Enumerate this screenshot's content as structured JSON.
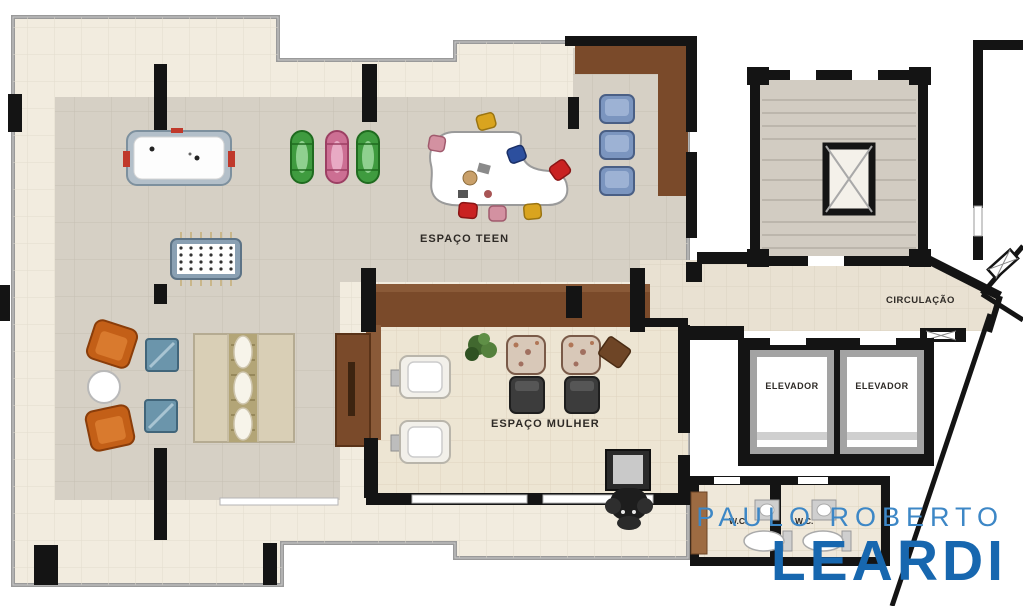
{
  "document": {
    "type": "residential floor plan (leisure floor)"
  },
  "rooms": {
    "teen": {
      "label": "ESPAÇO TEEN"
    },
    "mulher": {
      "label": "ESPAÇO MULHER"
    },
    "circulacao": {
      "label": "CIRCULAÇÃO"
    },
    "elevators": {
      "left": "ELEVADOR",
      "right": "ELEVADOR"
    },
    "wc": {
      "left": "W.C.",
      "right": "W.C."
    }
  },
  "branding": {
    "line1": "PAULO ROBERTO",
    "line2": "LEARDI",
    "color_line1": "#3d87c6",
    "color_line2": "#1767af"
  },
  "colors": {
    "terrace_floor": "#f2ecdf",
    "interior_floor": "#d6d0c5",
    "mulher_floor": "#ede5d3",
    "circulation_floor": "#e9e1d2",
    "stair_floor": "#d2ccc2",
    "wall_black": "#141414",
    "boundary_gray": "#9a9a9a",
    "wood_brown": "#7a4a2a",
    "orange_chair": "#c35f17",
    "blue_armchair": "#7b95bf"
  },
  "furniture_icons": [
    "air-hockey-table-icon",
    "kayak-green-icon",
    "kayak-pink-icon",
    "kayak-green2-icon",
    "foosball-table-icon",
    "kidney-desk-icon",
    "desk-chair-icon",
    "blue-armchair-icon",
    "orange-armchair-icon",
    "round-table-icon",
    "blue-pouf-icon",
    "daybed-icon",
    "sideboard-icon",
    "salon-chair-icon",
    "plant-icon",
    "floral-armchair-icon",
    "dark-ottoman-icon",
    "tilted-table-icon",
    "massage-chair-icon",
    "sink-icon",
    "toilet-icon",
    "stairs-icon",
    "shaft-icon"
  ]
}
